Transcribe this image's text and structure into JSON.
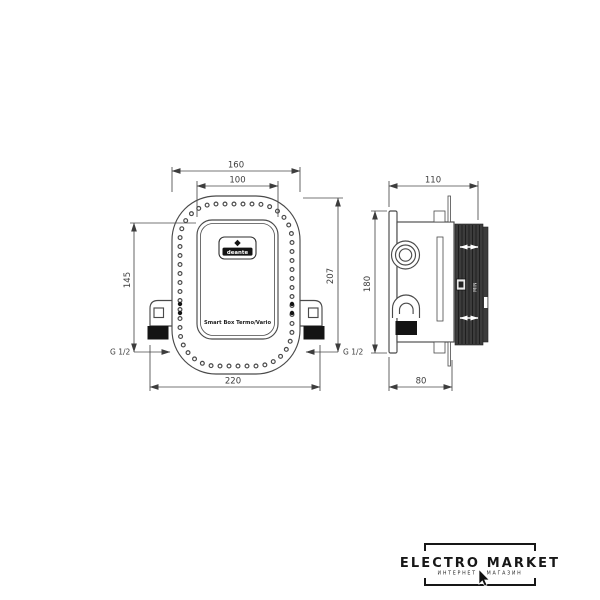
{
  "front_view": {
    "dim_outer_width": "160",
    "dim_inner_width": "100",
    "dim_left_height": "145",
    "dim_right_height": "207",
    "dim_total_width": "220",
    "thread_left": "G 1/2",
    "thread_right": "G 1/2",
    "brand_logo": "deante",
    "product_label": "Smart Box Termo/Vario"
  },
  "side_view": {
    "dim_depth": "110",
    "dim_height": "180",
    "dim_body_depth": "80",
    "depth_marker": "MIN"
  },
  "footer_logo": {
    "title": "ELECTRO MARKET",
    "subtitle": "ИНТЕРНЕТ - МАГАЗИН"
  },
  "colors": {
    "line": "#4a4a4a",
    "black_fill": "#141414",
    "ribbed_block": "#3c3c3c",
    "background": "#ffffff"
  }
}
